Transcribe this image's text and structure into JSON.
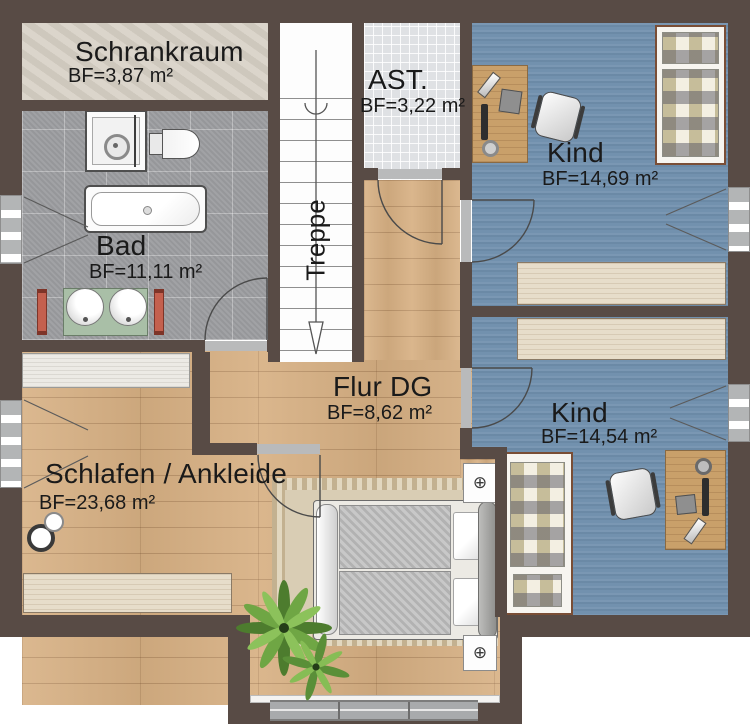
{
  "plan_type": "floor-plan",
  "rooms": {
    "schrankraum": {
      "name": "Schrankraum",
      "area": "BF=3,87 m²"
    },
    "ast": {
      "name": "AST.",
      "area": "BF=3,22 m²"
    },
    "kind_top": {
      "name": "Kind",
      "area": "BF=14,69 m²"
    },
    "bad": {
      "name": "Bad",
      "area": "BF=11,11 m²"
    },
    "treppe": {
      "name": "Treppe"
    },
    "flur": {
      "name": "Flur DG",
      "area": "BF=8,62 m²"
    },
    "kind_bottom": {
      "name": "Kind",
      "area": "BF=14,54 m²"
    },
    "schlafen": {
      "name": "Schlafen / Ankleide",
      "area": "BF=23,68 m²"
    }
  },
  "icons": {
    "nightstand_lamp": "⊕"
  },
  "fixtures": [
    "stairs",
    "shower",
    "toilet",
    "bathtub",
    "washbasin",
    "radiator",
    "double-bed",
    "single-bed",
    "desk",
    "office-chair",
    "wardrobe",
    "rug",
    "plant",
    "roof-window",
    "window",
    "door"
  ],
  "colors": {
    "wall": "#584b45",
    "wood_floor": "#d7b083",
    "bad_tiles": "#9c9da0",
    "ast_tiles": "#dfe1e4",
    "kind_floor": "#7291ae",
    "schrankraum_floor": "#d5cec3",
    "radiator_red": "#c4604e",
    "counter_green": "#a9bfa7",
    "label_text": "#1a1a1a"
  }
}
